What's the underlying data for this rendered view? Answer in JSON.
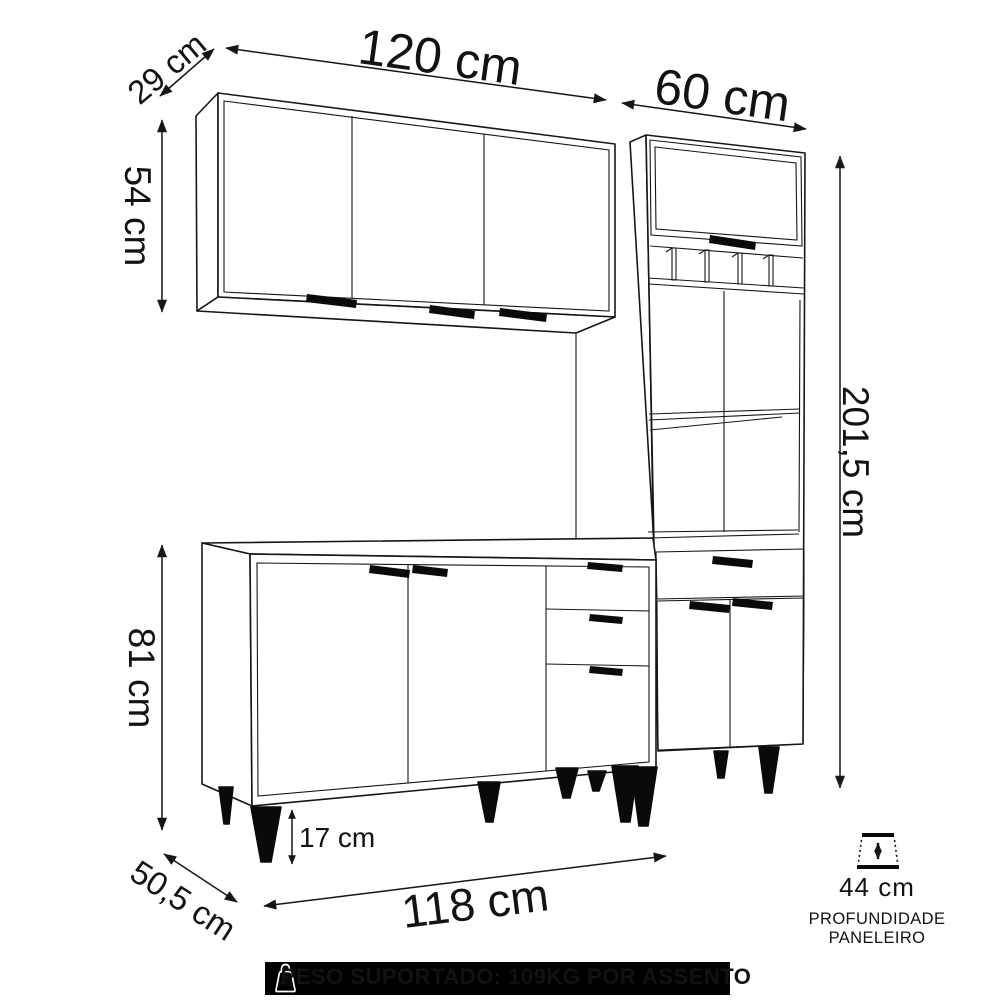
{
  "diagram": {
    "background": "#ffffff",
    "line_color": "#161616",
    "accent_black": "#0a0a0a",
    "dimensions": {
      "wall_cabinet_depth": "29 cm",
      "wall_cabinet_width": "120 cm",
      "wall_cabinet_height": "54 cm",
      "pantry_width": "60 cm",
      "total_height": "201,5 cm",
      "counter_height": "81 cm",
      "leg_height": "17 cm",
      "counter_depth": "50,5 cm",
      "counter_width": "118 cm",
      "pantry_shelf_depth": "44 cm"
    },
    "captions": {
      "pantry_depth_line1": "PROFUNDIDADE",
      "pantry_depth_line2": "PANELEIRO"
    },
    "banner": {
      "text": "PESO SUPORTADO: 109KG POR ASSENTO",
      "icon_label": "KG",
      "bg": "#000000",
      "fg": "#ffffff"
    },
    "icons": {
      "kg_weight_icon": "weight with KG engraving",
      "depth_arrow_icon": "vertical double arrow between planes"
    }
  }
}
